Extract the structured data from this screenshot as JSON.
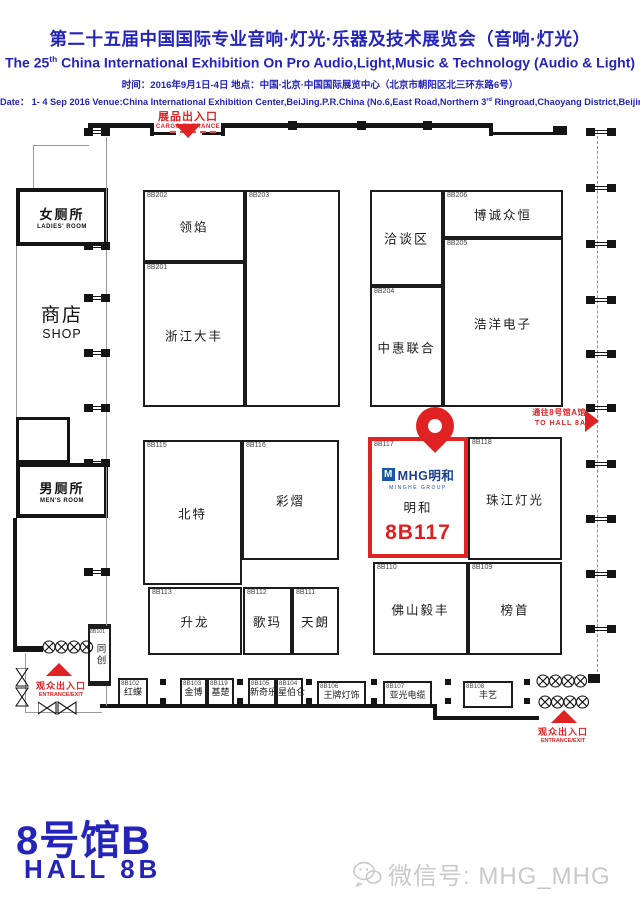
{
  "accent_blue": "#2424bb",
  "accent_red": "#e02222",
  "header": {
    "title_zh": "第二十五届中国国际专业音响·灯光·乐器及技术展览会（音响·灯光）",
    "title_en": {
      "pre": "The 25",
      "sup": "th",
      "post": " China International Exhibition On Pro Audio,Light,Music & Technology (Audio & Light)"
    },
    "info_zh": "时间：2016年9月1日-4日  地点：中国·北京·中国国际展览中心（北京市朝阳区北三环东路6号）",
    "info_en": {
      "pre": "Date：  1- 4 Sep 2016 Venue:China International Exhibition Center,BeiJing.P.R.China (No.6,East Road,Northern 3",
      "sup": "rd",
      "post": " Ringroad,Chaoyang District,Beijing)"
    }
  },
  "map": {
    "cargo": {
      "zh": "展品出入口",
      "en": "CARGO  ENTRANCE"
    },
    "to_hall": {
      "zh": "通往8号馆A馆",
      "en": "TO HALL 8A"
    },
    "entrance": {
      "zh": "观众出入口",
      "en": "ENTRANCE/EXIT"
    },
    "rooms": {
      "ladies": {
        "zh": "女厕所",
        "en": "LADIES'  ROOM"
      },
      "shop": {
        "zh": "商店",
        "en": "SHOP"
      },
      "mens": {
        "zh": "男厕所",
        "en": "MEN'S ROOM"
      }
    },
    "meeting_area": "洽谈区",
    "booths": [
      {
        "id": "8B202",
        "name": "领焰",
        "x": 143,
        "y": 190,
        "w": 102,
        "h": 72
      },
      {
        "id": "8B203",
        "name": "",
        "x": 245,
        "y": 190,
        "w": 95,
        "h": 217
      },
      {
        "id": "8B201",
        "name": "浙江大丰",
        "x": 143,
        "y": 262,
        "w": 102,
        "h": 145
      },
      {
        "id": "8B204",
        "name": "中惠联合",
        "x": 370,
        "y": 286,
        "w": 73,
        "h": 121
      },
      {
        "id": "8B206",
        "name": "博诚众恒",
        "x": 443,
        "y": 190,
        "w": 120,
        "h": 48
      },
      {
        "id": "8B205",
        "name": "浩洋电子",
        "x": 443,
        "y": 238,
        "w": 120,
        "h": 169
      },
      {
        "id": "8B115",
        "name": "北特",
        "x": 143,
        "y": 440,
        "w": 99,
        "h": 145
      },
      {
        "id": "8B116",
        "name": "彩熠",
        "x": 242,
        "y": 440,
        "w": 97,
        "h": 120
      },
      {
        "id": "8B113",
        "name": "升龙",
        "x": 148,
        "y": 587,
        "w": 94,
        "h": 68
      },
      {
        "id": "8B112",
        "name": "歌玛",
        "x": 243,
        "y": 587,
        "w": 49,
        "h": 68
      },
      {
        "id": "8B111",
        "name": "天朗",
        "x": 292,
        "y": 587,
        "w": 47,
        "h": 68
      },
      {
        "id": "8B118",
        "name": "珠江灯光",
        "x": 468,
        "y": 437,
        "w": 94,
        "h": 123
      },
      {
        "id": "8B110",
        "name": "佛山毅丰",
        "x": 373,
        "y": 562,
        "w": 95,
        "h": 93
      },
      {
        "id": "8B109",
        "name": "榜首",
        "x": 468,
        "y": 562,
        "w": 94,
        "h": 93
      },
      {
        "id": "8B101",
        "name": "同创",
        "x": 88,
        "y": 624,
        "w": 23,
        "h": 62,
        "vertical": true
      },
      {
        "id": "8B102",
        "name": "红蝶",
        "x": 118,
        "y": 678,
        "w": 30,
        "h": 28,
        "small": true
      },
      {
        "id": "8B103",
        "name": "金博",
        "x": 180,
        "y": 678,
        "w": 27,
        "h": 28,
        "small": true
      },
      {
        "id": "8B119",
        "name": "基楚",
        "x": 207,
        "y": 678,
        "w": 27,
        "h": 28,
        "small": true
      },
      {
        "id": "8B105",
        "name": "新奇乐",
        "x": 248,
        "y": 678,
        "w": 28,
        "h": 28,
        "small": true
      },
      {
        "id": "8B104",
        "name": "星伯仑",
        "x": 276,
        "y": 678,
        "w": 27,
        "h": 28,
        "small": true
      },
      {
        "id": "8B106",
        "name": "王牌灯饰",
        "x": 317,
        "y": 681,
        "w": 49,
        "h": 27,
        "small": true
      },
      {
        "id": "8B107",
        "name": "亚光电缆",
        "x": 383,
        "y": 681,
        "w": 49,
        "h": 27,
        "small": true
      },
      {
        "id": "8B108",
        "name": "丰艺",
        "x": 463,
        "y": 681,
        "w": 50,
        "h": 27,
        "small": true
      }
    ],
    "highlight": {
      "id": "8B117",
      "logo_mark": "M",
      "logo_text": "MHG明和",
      "logo_sub": "MINGHE GROUP",
      "name": "明和",
      "big_id": "8B117"
    }
  },
  "footer": {
    "hall_zh": "8号馆B",
    "hall_en": "HALL 8B",
    "watermark": "微信号: MHG_MHG"
  }
}
